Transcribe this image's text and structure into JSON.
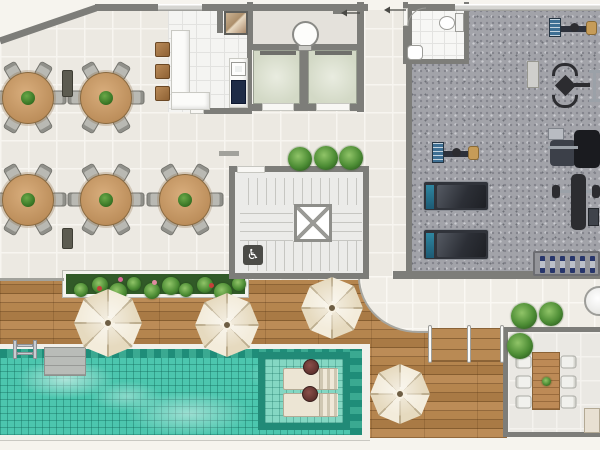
{
  "canvas": {
    "w": 600,
    "h": 450
  },
  "palette": {
    "page": "#f6f4ee",
    "wall": "#7d7d79",
    "wallLight": "#a2a29c",
    "window": "#d6d6d2",
    "diningTile": "#ece9e2",
    "kitchenTile": "#f4f4f2",
    "hallTile": "#e4e1db",
    "stairTile": "#ebebe9",
    "gymCarpet": "#a2a3a9",
    "terraceTile": "#eae8e3",
    "bathTile": "#f7f7f5",
    "deckWood": "#b2814c",
    "poolWater": "#4cc6ae",
    "poolBorder": "#1f8d79",
    "poolShelf": "#84d7c3",
    "coping": "#f1f0ea",
    "elevatorCab": "#d9decb",
    "umbrellaCream": "#f0e6d2",
    "tableWood": "#c89c6c",
    "chairGray": "#b9b9b3",
    "stoolWood": "#a87c4e",
    "plantGreen": "#4c8c34",
    "planterBed": "#315a28",
    "loungerCream": "#ece5d4",
    "cooktopNavy": "#1f2c47",
    "dumbbellBlue": "#27356b",
    "sideTableMaroon": "#5f322e"
  },
  "icons": {
    "wheelchair": "♿"
  },
  "rooms": {
    "dining": {
      "x": 0,
      "y": 0,
      "w": 412,
      "h": 284,
      "clip": "polygon(0px 42px, 97px 10px, 412px 10px, 412px 284px, 0px 284px)"
    },
    "deck": {
      "x": 0,
      "y": 280,
      "w": 507,
      "h": 158
    },
    "walkway": {
      "x": 358,
      "y": 276,
      "w": 242,
      "h": 57
    },
    "kitchen": {
      "x": 168,
      "y": 10,
      "w": 84,
      "h": 102
    },
    "hall": {
      "x": 252,
      "y": 8,
      "w": 106,
      "h": 37
    },
    "cab1": {
      "x": 253,
      "y": 50,
      "w": 47,
      "h": 54
    },
    "cab2": {
      "x": 308,
      "y": 50,
      "w": 49,
      "h": 54
    },
    "stairFloor": {
      "x": 235,
      "y": 172,
      "w": 128,
      "h": 101
    },
    "gym": {
      "x": 412,
      "y": 8,
      "w": 188,
      "h": 264
    },
    "bath": {
      "x": 408,
      "y": 7,
      "w": 56,
      "h": 52
    },
    "terrace": {
      "x": 508,
      "y": 332,
      "w": 92,
      "h": 100
    },
    "pool": {
      "x": 0,
      "y": 344,
      "w": 370,
      "h": 96
    }
  },
  "walls": [
    [
      95,
      4,
      63,
      7
    ],
    [
      202,
      4,
      166,
      7
    ],
    [
      406,
      4,
      49,
      7
    ],
    [
      247,
      10,
      5,
      102
    ],
    [
      204,
      108,
      48,
      6
    ],
    [
      217,
      10,
      6,
      23
    ],
    [
      247,
      2,
      6,
      48
    ],
    [
      357,
      2,
      7,
      110
    ],
    [
      247,
      44,
      117,
      6
    ],
    [
      300,
      50,
      8,
      56
    ],
    [
      247,
      104,
      16,
      7
    ],
    [
      294,
      104,
      22,
      7
    ],
    [
      350,
      104,
      14,
      7
    ],
    [
      229,
      166,
      140,
      6
    ],
    [
      229,
      166,
      6,
      113
    ],
    [
      363,
      166,
      6,
      113
    ],
    [
      229,
      273,
      140,
      6
    ],
    [
      406,
      8,
      6,
      264
    ],
    [
      393,
      271,
      207,
      8
    ],
    [
      403,
      2,
      5,
      62
    ],
    [
      464,
      2,
      5,
      62
    ],
    [
      403,
      59,
      66,
      5
    ],
    [
      503,
      327,
      97,
      5
    ],
    [
      503,
      327,
      5,
      110
    ],
    [
      503,
      432,
      97,
      5
    ]
  ],
  "wallsLight": [
    [
      219,
      151,
      20,
      5
    ],
    [
      0,
      278,
      64,
      3
    ]
  ],
  "windows": [
    [
      158,
      4,
      44,
      7
    ],
    [
      455,
      4,
      145,
      7
    ]
  ],
  "gaps": [
    [
      237,
      166,
      28,
      7
    ],
    [
      403,
      8,
      5,
      18
    ],
    [
      190,
      108,
      14,
      6
    ]
  ],
  "sillsDark": [
    [
      260,
      51,
      36,
      4
    ],
    [
      315,
      51,
      37,
      4
    ]
  ],
  "sillsWhite": [
    [
      262,
      103,
      32,
      8
    ],
    [
      316,
      103,
      34,
      8
    ]
  ],
  "stair": {
    "bandsV": [
      [
        248,
        178,
        112,
        27
      ],
      [
        248,
        241,
        112,
        30
      ]
    ],
    "bandsH": [
      [
        240,
        205,
        53,
        36
      ],
      [
        332,
        205,
        30,
        36
      ]
    ],
    "shaft": [
      294,
      204,
      38,
      38
    ],
    "badge": [
      243,
      245,
      20,
      20
    ]
  },
  "kitchenItems": {
    "counters": [
      [
        171,
        30,
        19,
        80
      ],
      [
        171,
        92,
        39,
        18
      ],
      [
        229,
        58,
        19,
        50
      ]
    ],
    "granite": [
      224,
      11,
      24,
      24
    ],
    "sink": [
      231,
      62,
      15,
      14
    ],
    "cooktop": [
      231,
      80,
      15,
      24
    ],
    "stools": [
      [
        155,
        42,
        15,
        15
      ],
      [
        155,
        64,
        15,
        15
      ],
      [
        155,
        86,
        15,
        15
      ]
    ]
  },
  "hallItems": {
    "chute": [
      292,
      21,
      27,
      27
    ],
    "chuteTab": [
      298,
      45,
      14,
      6
    ],
    "shelf": [
      333,
      9,
      14,
      5
    ]
  },
  "bathItems": {
    "toilet": [
      439,
      16,
      16,
      14
    ],
    "tank": [
      455,
      13,
      9,
      19
    ],
    "sink": [
      407,
      45,
      16,
      15
    ]
  },
  "dining": {
    "tables": [
      [
        28,
        98
      ],
      [
        106,
        98
      ],
      [
        28,
        200
      ],
      [
        106,
        200
      ],
      [
        185,
        200
      ]
    ],
    "tableRadius": 26,
    "chairAngles": [
      30,
      90,
      150,
      210,
      270,
      330
    ],
    "sideTables": [
      [
        62,
        70,
        11,
        27
      ],
      [
        62,
        228,
        11,
        21
      ]
    ]
  },
  "planter": {
    "box": [
      63,
      271,
      185,
      26
    ],
    "flowers": [
      [
        118,
        277,
        "#d86a9a"
      ],
      [
        97,
        286,
        "#c4403a"
      ],
      [
        152,
        280,
        "#e08aa0"
      ],
      [
        209,
        283,
        "#c4403a"
      ]
    ]
  },
  "plants": [
    [
      300,
      159,
      12
    ],
    [
      326,
      158,
      12
    ],
    [
      351,
      158,
      12
    ],
    [
      524,
      316,
      13
    ],
    [
      551,
      314,
      12
    ],
    [
      520,
      346,
      13
    ]
  ],
  "umbrellas": [
    [
      108,
      323,
      34
    ],
    [
      227,
      325,
      32
    ],
    [
      332,
      308,
      31
    ],
    [
      400,
      394,
      30
    ]
  ],
  "poolItems": {
    "water": [
      0,
      349,
      362,
      86
    ],
    "bandTop": [
      0,
      349,
      362,
      9
    ],
    "bandRight": [
      350,
      349,
      12,
      86
    ],
    "shelf": [
      258,
      352,
      92,
      78
    ],
    "platform": [
      44,
      347,
      42,
      29
    ],
    "ladder": [
      13,
      340,
      24,
      19
    ],
    "loungers": [
      [
        283,
        368,
        55,
        22
      ],
      [
        283,
        393,
        55,
        24
      ]
    ],
    "tables": [
      [
        303,
        359,
        16,
        16
      ],
      [
        302,
        386,
        16,
        16
      ]
    ]
  },
  "steps": {
    "treads": [
      431,
      328,
      72,
      34
    ],
    "rails": [
      [
        428,
        325,
        4,
        38
      ],
      [
        467,
        325,
        4,
        38
      ],
      [
        500,
        325,
        4,
        38
      ]
    ]
  },
  "terraceItems": {
    "table": [
      532,
      352,
      28,
      58
    ],
    "chairsLeft": [
      [
        517,
        354
      ],
      [
        517,
        374
      ],
      [
        517,
        394
      ]
    ],
    "chairsRight": [
      [
        562,
        354
      ],
      [
        562,
        374
      ],
      [
        562,
        394
      ]
    ],
    "grill": [
      584,
      286,
      30,
      30
    ],
    "counter": [
      584,
      408,
      16,
      25
    ],
    "centerpiece": [
      542,
      377,
      9,
      9
    ]
  },
  "gymEquipment": [
    {
      "type": "bike",
      "x": 432,
      "y": 141,
      "w": 48,
      "h": 25
    },
    {
      "type": "bike",
      "x": 549,
      "y": 17,
      "w": 49,
      "h": 23
    },
    {
      "type": "treadmill",
      "x": 423,
      "y": 181,
      "w": 66,
      "h": 30
    },
    {
      "type": "treadmill",
      "x": 423,
      "y": 229,
      "w": 66,
      "h": 31
    },
    {
      "type": "mat",
      "x": 527,
      "y": 61,
      "w": 12,
      "h": 27
    },
    {
      "type": "multi-gym",
      "x": 546,
      "y": 63,
      "w": 44,
      "h": 46
    },
    {
      "type": "bar-rack",
      "x": 589,
      "y": 70,
      "w": 11,
      "h": 32
    },
    {
      "type": "leg-press",
      "x": 548,
      "y": 126,
      "w": 52,
      "h": 42
    },
    {
      "type": "bench-press",
      "x": 552,
      "y": 174,
      "w": 48,
      "h": 56
    },
    {
      "type": "dumbbell-rack",
      "x": 533,
      "y": 251,
      "w": 67,
      "h": 25
    }
  ],
  "annotations": {
    "diagonalWall": [
      0,
      41,
      96,
      8
    ],
    "arrows": [
      [
        406,
        10,
        384,
        10
      ],
      [
        360,
        13,
        341,
        13
      ]
    ],
    "doorArc": "M408,26 A18,18 0 0 1 426,8"
  }
}
